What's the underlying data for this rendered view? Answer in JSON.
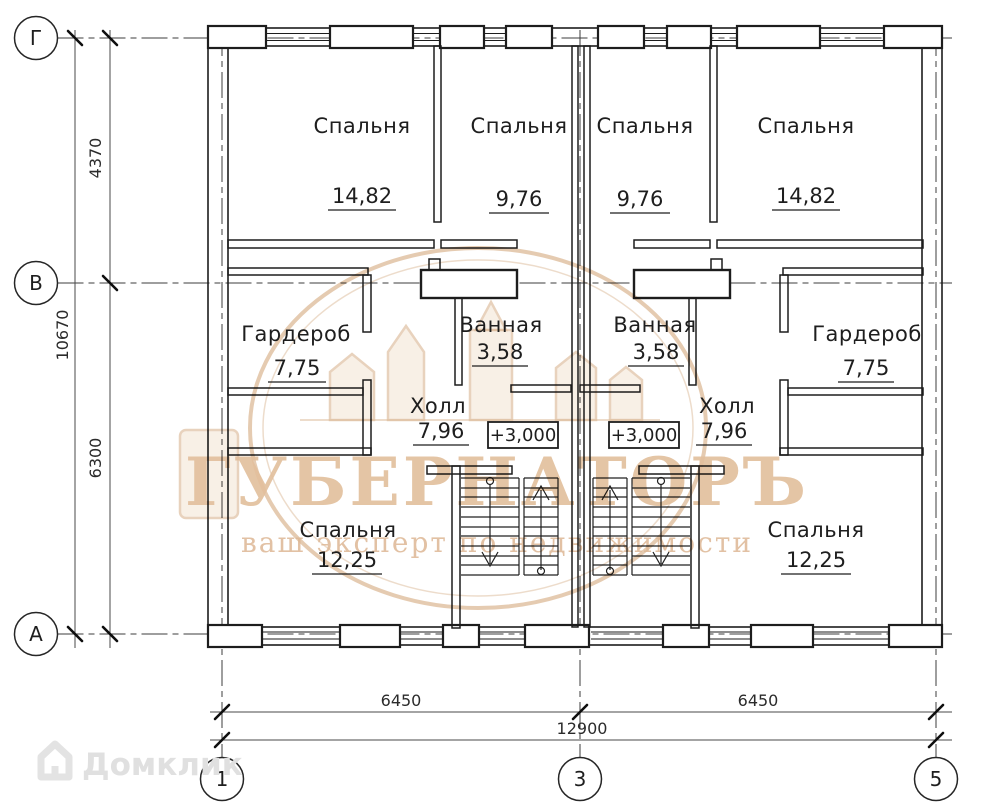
{
  "plan": {
    "rooms": [
      {
        "name": "Спальня",
        "area": "14,82"
      },
      {
        "name": "Спальня",
        "area": "9,76"
      },
      {
        "name": "Спальня",
        "area": "9,76"
      },
      {
        "name": "Спальня",
        "area": "14,82"
      },
      {
        "name": "Гардероб",
        "area": "7,75"
      },
      {
        "name": "Ванная",
        "area": "3,58"
      },
      {
        "name": "Ванная",
        "area": "3,58"
      },
      {
        "name": "Гардероб",
        "area": "7,75"
      },
      {
        "name": "Холл",
        "area": "7,96"
      },
      {
        "name": "Холл",
        "area": "7,96"
      },
      {
        "name": "Спальня",
        "area": "12,25"
      },
      {
        "name": "Спальня",
        "area": "12,25"
      }
    ],
    "elevations": [
      "+3,000",
      "+3,000"
    ],
    "axes": {
      "rows": [
        "Г",
        "В",
        "А"
      ],
      "cols": [
        "1",
        "3",
        "5"
      ]
    },
    "dims": {
      "v_total": "10670",
      "v_top": "4370",
      "v_bottom": "6300",
      "h_left": "6450",
      "h_right": "6450",
      "h_total": "12900"
    }
  },
  "watermark": {
    "title": "ГУБЕРНАТОРЪ",
    "subtitle": "ваш эксперт по недвижимости"
  },
  "logo": {
    "label": "Домклик"
  },
  "colors": {
    "line": "#1d1d1d",
    "watermark_sepia": "#e2bf9c",
    "logo_gray": "#e0e0e0"
  }
}
